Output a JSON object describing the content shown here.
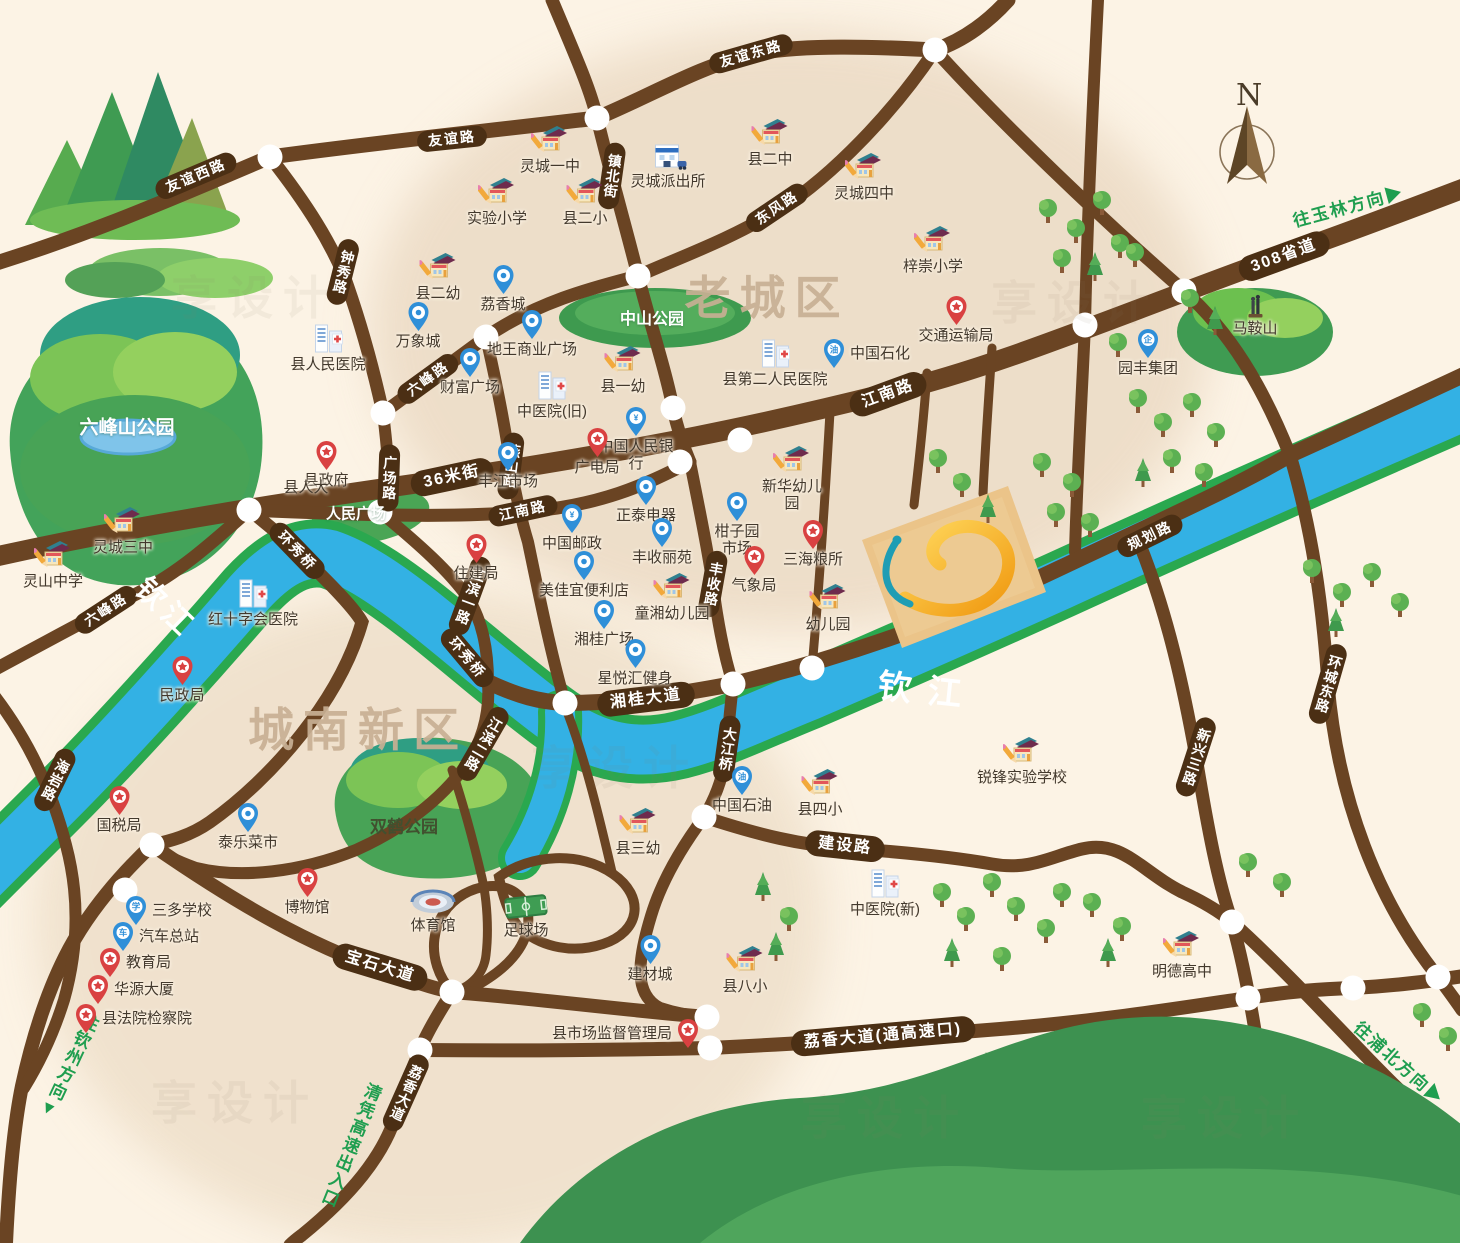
{
  "map": {
    "compass": {
      "label": "N"
    },
    "watermark": {
      "text": "享设计"
    },
    "colors": {
      "background": "#fcf3e5",
      "road": "#6a4423",
      "road_pill": "#4b2f14",
      "river_blue": "#33b1e4",
      "river_bank_green": "#2aa84f",
      "park_green": "#48a356",
      "area_text": "#c8b094",
      "direction_green": "#1f9e4f",
      "logo_gold": "#f5a81f",
      "logo_teal": "#1f9db4",
      "parcel_tan": "#ebc489"
    },
    "areas": [
      {
        "t": "老城区",
        "x": 767,
        "y": 295
      },
      {
        "t": "城南新区",
        "x": 358,
        "y": 727
      }
    ],
    "rivers": [
      {
        "t": "钦江",
        "x": 168,
        "y": 606,
        "r": 44,
        "s": 30,
        "ls": 6
      },
      {
        "t": "钦江",
        "x": 928,
        "y": 688,
        "r": 6,
        "s": 34,
        "ls": 16
      }
    ],
    "road_labels": [
      {
        "t": "友谊西路",
        "x": 196,
        "y": 176,
        "r": -23
      },
      {
        "t": "友谊路",
        "x": 452,
        "y": 139,
        "r": -6
      },
      {
        "t": "友谊东路",
        "x": 751,
        "y": 54,
        "r": -16
      },
      {
        "t": "镇北街",
        "x": 612,
        "y": 176,
        "r": 8,
        "v": true
      },
      {
        "t": "东风路",
        "x": 777,
        "y": 208,
        "r": -34
      },
      {
        "t": "钟秀路",
        "x": 343,
        "y": 272,
        "r": 14,
        "v": true
      },
      {
        "t": "六峰路",
        "x": 428,
        "y": 379,
        "r": -36
      },
      {
        "t": "燕山路",
        "x": 511,
        "y": 466,
        "r": 7,
        "v": true
      },
      {
        "t": "广场路",
        "x": 389,
        "y": 478,
        "r": 2,
        "v": true
      },
      {
        "t": "36米街",
        "x": 452,
        "y": 477,
        "r": -12,
        "big": true
      },
      {
        "t": "江南路",
        "x": 888,
        "y": 394,
        "r": -20,
        "big": true
      },
      {
        "t": "江南路",
        "x": 523,
        "y": 511,
        "r": -12
      },
      {
        "t": "308省道",
        "x": 1284,
        "y": 256,
        "r": -20,
        "big": true
      },
      {
        "t": "规划路",
        "x": 1150,
        "y": 536,
        "r": -26
      },
      {
        "t": "丰收路",
        "x": 713,
        "y": 584,
        "r": 10,
        "v": true
      },
      {
        "t": "江滨一路",
        "x": 470,
        "y": 596,
        "r": 20,
        "v": true
      },
      {
        "t": "环秀桥",
        "x": 297,
        "y": 551,
        "r": 46
      },
      {
        "t": "环秀桥",
        "x": 467,
        "y": 658,
        "r": 50
      },
      {
        "t": "江滨二路",
        "x": 483,
        "y": 744,
        "r": 30,
        "v": true
      },
      {
        "t": "湘桂大道",
        "x": 646,
        "y": 699,
        "r": -7,
        "big": true
      },
      {
        "t": "大江桥",
        "x": 727,
        "y": 749,
        "r": 8,
        "v": true
      },
      {
        "t": "建设路",
        "x": 845,
        "y": 846,
        "r": 6,
        "big": true
      },
      {
        "t": "新兴三路",
        "x": 1196,
        "y": 757,
        "r": 18,
        "v": true
      },
      {
        "t": "环城东路",
        "x": 1328,
        "y": 684,
        "r": 16,
        "v": true
      },
      {
        "t": "海岩路",
        "x": 55,
        "y": 780,
        "r": 26,
        "v": true
      },
      {
        "t": "六峰路",
        "x": 106,
        "y": 610,
        "r": -33
      },
      {
        "t": "宝石大道",
        "x": 380,
        "y": 967,
        "r": 17,
        "big": true
      },
      {
        "t": "荔香大道",
        "x": 406,
        "y": 1093,
        "r": 24,
        "v": true
      },
      {
        "t": "荔香大道(通高速口)",
        "x": 883,
        "y": 1036,
        "r": -5,
        "big": true
      }
    ],
    "directions": [
      {
        "t": "往玉林方向",
        "x": 1348,
        "y": 205,
        "r": -15,
        "arrow": "▶"
      },
      {
        "t": "往钦州方向",
        "x": 68,
        "y": 1066,
        "r": 25,
        "v": true,
        "arrow": "▼"
      },
      {
        "t": "往浦北方向",
        "x": 1400,
        "y": 1062,
        "r": 42,
        "arrow": "▶"
      },
      {
        "t": "清凭高速出入口",
        "x": 350,
        "y": 1145,
        "r": 22,
        "v": true,
        "arrow": ""
      }
    ],
    "parks": [
      {
        "t": "六峰山公园",
        "x": 127,
        "y": 426,
        "light": true,
        "s": 19
      },
      {
        "t": "中山公园",
        "x": 652,
        "y": 317,
        "light": true,
        "s": 16
      },
      {
        "t": "人民广场",
        "x": 356,
        "y": 513,
        "light": true,
        "s": 15
      },
      {
        "t": "双鹤公园",
        "x": 404,
        "y": 825,
        "light": false,
        "s": 17
      }
    ],
    "pois": [
      {
        "label": "灵城一中",
        "icon": "school",
        "x": 550,
        "y": 143
      },
      {
        "label": "实验小学",
        "icon": "school",
        "x": 497,
        "y": 195
      },
      {
        "label": "县二小",
        "icon": "school",
        "x": 585,
        "y": 195
      },
      {
        "label": "县二幼",
        "icon": "school",
        "x": 438,
        "y": 270
      },
      {
        "label": "灵城派出所",
        "icon": "police",
        "x": 668,
        "y": 160
      },
      {
        "label": "县二中",
        "icon": "school",
        "x": 770,
        "y": 136
      },
      {
        "label": "灵城四中",
        "icon": "school",
        "x": 864,
        "y": 170
      },
      {
        "label": "梓崇小学",
        "icon": "school",
        "x": 933,
        "y": 243
      },
      {
        "label": "县一幼",
        "icon": "school",
        "x": 623,
        "y": 363
      },
      {
        "label": "县人民医院",
        "icon": "hospital",
        "x": 328,
        "y": 341
      },
      {
        "label": "万象城",
        "icon": "pin-blue",
        "x": 418,
        "y": 322
      },
      {
        "label": "荔香城",
        "icon": "pin-blue",
        "x": 503,
        "y": 285
      },
      {
        "label": "地王商业广场",
        "icon": "pin-blue",
        "x": 532,
        "y": 330
      },
      {
        "label": "财富广场",
        "icon": "pin-blue",
        "x": 470,
        "y": 368
      },
      {
        "label": "中医院(旧)",
        "icon": "hospital",
        "x": 552,
        "y": 388
      },
      {
        "label": "中国人民银行",
        "icon": "pin-blue",
        "x": 636,
        "y": 427,
        "glyph": "¥",
        "w": 80
      },
      {
        "label": "广电局",
        "icon": "pin-red",
        "x": 597,
        "y": 448
      },
      {
        "label": "丰江市场",
        "icon": "pin-blue",
        "x": 508,
        "y": 462
      },
      {
        "label": "县第二人民医院",
        "icon": "hospital",
        "x": 775,
        "y": 356
      },
      {
        "label": "中国石化",
        "icon": "pin-blue",
        "x": 838,
        "y": 354,
        "glyph": "油",
        "side": "r"
      },
      {
        "label": "交通运输局",
        "icon": "pin-red",
        "x": 956,
        "y": 316
      },
      {
        "label": "县政府",
        "icon": "pin-red",
        "x": 326,
        "y": 461
      },
      {
        "label": "县人大",
        "icon": "none",
        "x": 306,
        "y": 499
      },
      {
        "label": "住建局",
        "icon": "pin-red",
        "x": 476,
        "y": 554
      },
      {
        "label": "正泰电器",
        "icon": "pin-blue",
        "x": 646,
        "y": 496
      },
      {
        "label": "中国邮政",
        "icon": "pin-blue",
        "x": 572,
        "y": 524,
        "glyph": "¥"
      },
      {
        "label": "丰收丽苑",
        "icon": "pin-blue",
        "x": 662,
        "y": 538
      },
      {
        "label": "柑子园市场",
        "icon": "pin-blue",
        "x": 737,
        "y": 512,
        "w": 58
      },
      {
        "label": "气象局",
        "icon": "pin-red",
        "x": 754,
        "y": 566
      },
      {
        "label": "三海粮所",
        "icon": "pin-red",
        "x": 813,
        "y": 540
      },
      {
        "label": "美佳宜便利店",
        "icon": "pin-blue",
        "x": 584,
        "y": 571
      },
      {
        "label": "童湘幼儿园",
        "icon": "school",
        "x": 672,
        "y": 590
      },
      {
        "label": "湘桂广场",
        "icon": "pin-blue",
        "x": 604,
        "y": 620
      },
      {
        "label": "星悦汇健身",
        "icon": "pin-blue",
        "x": 635,
        "y": 659
      },
      {
        "label": "新华幼儿园",
        "icon": "school",
        "x": 792,
        "y": 463,
        "w": 66
      },
      {
        "label": "幼儿园",
        "icon": "school",
        "x": 828,
        "y": 601
      },
      {
        "label": "红十字会医院",
        "icon": "hospital",
        "x": 253,
        "y": 596
      },
      {
        "label": "民政局",
        "icon": "pin-red",
        "x": 182,
        "y": 676
      },
      {
        "label": "国税局",
        "icon": "pin-red",
        "x": 119,
        "y": 806
      },
      {
        "label": "灵城三中",
        "icon": "school",
        "x": 123,
        "y": 524
      },
      {
        "label": "灵山中学",
        "icon": "school",
        "x": 53,
        "y": 558
      },
      {
        "label": "泰乐菜市",
        "icon": "pin-blue",
        "x": 248,
        "y": 823
      },
      {
        "label": "三多学校",
        "icon": "pin-blue",
        "x": 140,
        "y": 911,
        "glyph": "学",
        "side": "r"
      },
      {
        "label": "汽车总站",
        "icon": "pin-blue",
        "x": 127,
        "y": 937,
        "glyph": "车",
        "side": "r"
      },
      {
        "label": "教育局",
        "icon": "pin-red",
        "x": 114,
        "y": 963,
        "side": "r"
      },
      {
        "label": "华源大厦",
        "icon": "pin-red",
        "x": 102,
        "y": 990,
        "side": "r"
      },
      {
        "label": "县法院检察院",
        "icon": "pin-red",
        "x": 90,
        "y": 1019,
        "side": "r"
      },
      {
        "label": "博物馆",
        "icon": "pin-red",
        "x": 307,
        "y": 888
      },
      {
        "label": "体育馆",
        "icon": "stadium",
        "x": 433,
        "y": 908
      },
      {
        "label": "足球场",
        "icon": "field",
        "x": 526,
        "y": 913
      },
      {
        "label": "县三幼",
        "icon": "school",
        "x": 638,
        "y": 825
      },
      {
        "label": "中国石油",
        "icon": "pin-blue",
        "x": 742,
        "y": 786,
        "glyph": "油"
      },
      {
        "label": "县四小",
        "icon": "school",
        "x": 820,
        "y": 786
      },
      {
        "label": "锐锋实验学校",
        "icon": "school",
        "x": 1022,
        "y": 754
      },
      {
        "label": "中医院(新)",
        "icon": "hospital",
        "x": 885,
        "y": 886
      },
      {
        "label": "建材城",
        "icon": "pin-blue",
        "x": 650,
        "y": 955
      },
      {
        "label": "县八小",
        "icon": "school",
        "x": 745,
        "y": 963
      },
      {
        "label": "县市场监督管理局",
        "icon": "pin-red",
        "x": 684,
        "y": 1034,
        "side": "l"
      },
      {
        "label": "明德高中",
        "icon": "school",
        "x": 1182,
        "y": 948
      },
      {
        "label": "园丰集团",
        "icon": "pin-blue",
        "x": 1148,
        "y": 349,
        "glyph": "企"
      },
      {
        "label": "马鞍山",
        "icon": "statue",
        "x": 1255,
        "y": 312
      }
    ]
  }
}
